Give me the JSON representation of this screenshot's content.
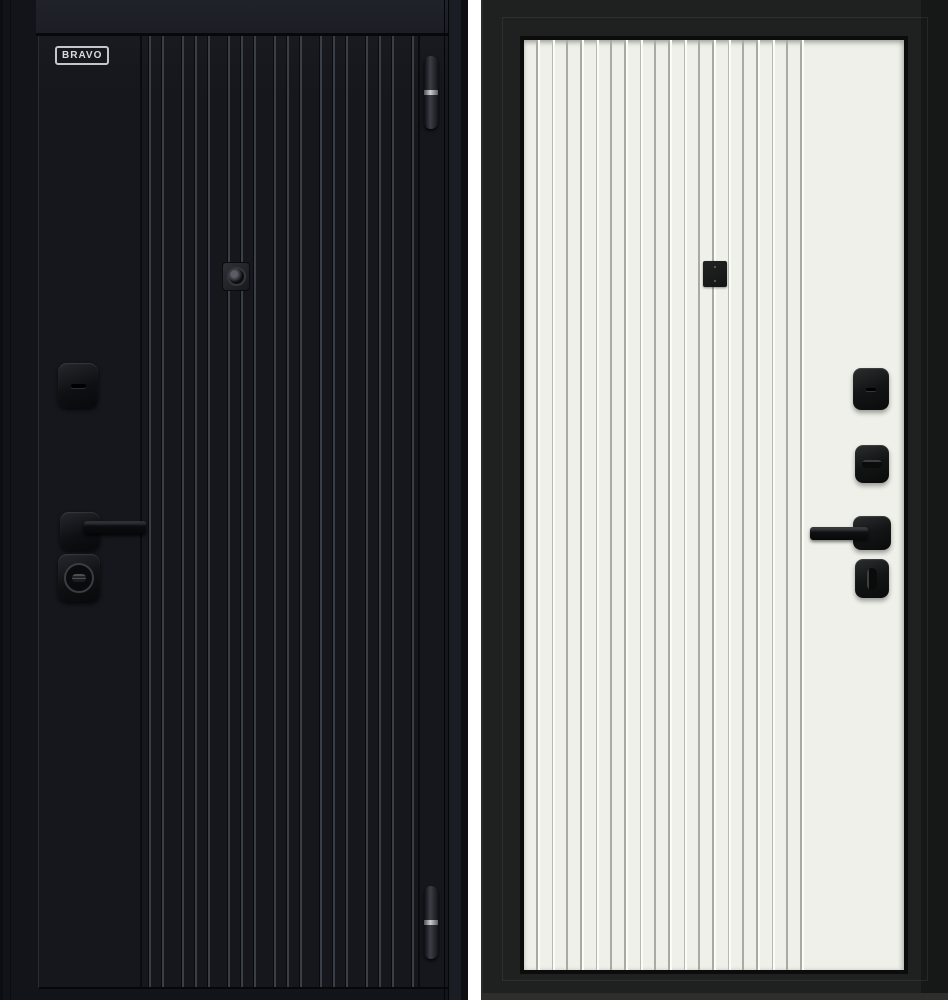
{
  "views": {
    "exterior": {
      "brand_label": "BRAVO"
    },
    "interior": {}
  },
  "colors": {
    "page-bg": "#ffffff",
    "ext-frame": "#12141a",
    "ext-leaf": "#15171d",
    "ext-groove": "#3a3e46",
    "ext-hw": "#0f1013",
    "logo-silver": "#c3c6ca",
    "hinge-accent": "#c9cdd1",
    "int-frame": "#1f2120",
    "int-leaf": "#eff0ea",
    "int-groove": "#a9aba3",
    "int-hw": "#131415"
  }
}
